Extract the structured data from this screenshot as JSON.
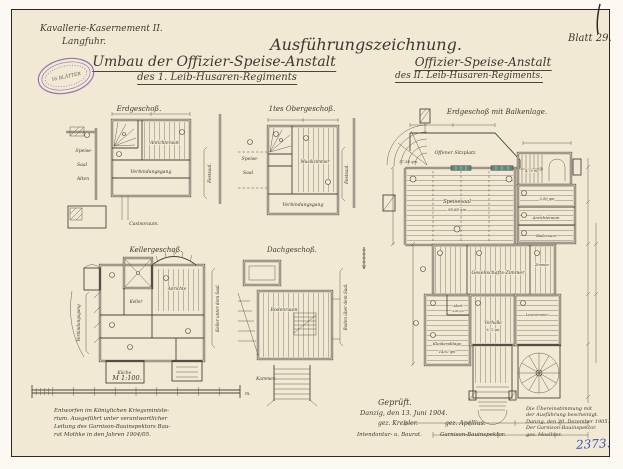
{
  "colors": {
    "paper": "#f2e9d4",
    "ink": "#3e382e",
    "stamp_purple": "#7a5ca8",
    "archive_blue": "#3952b8",
    "window_mark_teal": "#5e8a80"
  },
  "sheet": {
    "head_left1": "Kavallerie-Kasernement II.",
    "head_left2": "Langfuhr.",
    "title_main": "Ausführungszeichnung.",
    "subject_l1": "Umbau der Offizier-Speise-Anstalt",
    "subject_l2": "des 1. Leib-Husaren-Regiments",
    "subject_r1": "Offizier-Speise-Anstalt",
    "subject_r2": "des II. Leib-Husaren-Regiments.",
    "blatt": "Blatt 29.",
    "archive_no": "2373."
  },
  "stamp": {
    "center": "16 BLÄTTER"
  },
  "plans": {
    "p1": {
      "title": "Erdgeschoß.",
      "speise": "Speise-",
      "saal": "Saal",
      "alten": "Alten",
      "anrichte": "Anrichteraum",
      "gang": "Verbindungsgang",
      "casino": "Casinoraum.",
      "side": "Festsaal."
    },
    "p2": {
      "title": "1tes Obergeschoß.",
      "speise": "Speise-",
      "saal": "Saal",
      "musik": "Musikzimmer",
      "gang": "Verbindungsgang",
      "side": "Festsaal."
    },
    "p3": {
      "title": "Kellergeschoß.",
      "gang": "Verbindungsgang",
      "anrichte": "Anrichte",
      "keller": "Keller",
      "kueche": "Küche.",
      "side": "Keller unter dem Saal."
    },
    "p4": {
      "title": "Dachgeschoß.",
      "boden": "Bodenraum",
      "kammer": "Kammer.",
      "side": "Boden über dem Saal."
    },
    "p5": {
      "title": "Erdgeschoß mit Balkenlage.",
      "sitzplatz": "Offener Sitzplatz",
      "sitzplatz_qm": "17,38 qm",
      "speisesaal": "Speisesaal",
      "speisesaal_qm": "58,68 qm",
      "gesellschaft": "Gesellschafts-Zimmer",
      "zimmer1": "Zimmer",
      "vorhalle": "Vorhalle",
      "vorhalle_qm": "9,72 qm",
      "kleider": "Kleiderablage",
      "kleider_qm": "14,92 qm",
      "abort": "Abort",
      "abort_qm": "4,00 qm",
      "zimmer2": "Lesezimmer",
      "anrichte": "Anrichteraum",
      "bad": "Baderaum",
      "treppe_m": "4,79 m",
      "qm350": "3,50 qm"
    }
  },
  "scalebar": {
    "label": "M 1:100.",
    "unit": "m."
  },
  "notes": {
    "left1": "Entworfen im Königlichen Kriegsministe-",
    "left2": "rium. Ausgeführt unter verantwortlicher",
    "left3": "Leitung des Garnison-Bauinspektors Bau-",
    "left4": "rat Mothke in den Jahren 1904/05.",
    "gep": "Geprüft.",
    "gep_date": "Danzig, den 13. Juni 1904.",
    "sig1": "gez. Kreisler.",
    "sig2": "gez. Apellius.",
    "role1": "Intendantur- u. Baurat.",
    "role2": "Garnison-Bauinspektor."
  },
  "cert": {
    "l1": "Die Übereinstimmung mit",
    "l2": "der Ausführung bescheinigt.",
    "l3": "Danzig, den 20. Dezember 1905.",
    "l4": "Der Garnison-Bauinspektor.",
    "l5": "gez. Moellner."
  }
}
